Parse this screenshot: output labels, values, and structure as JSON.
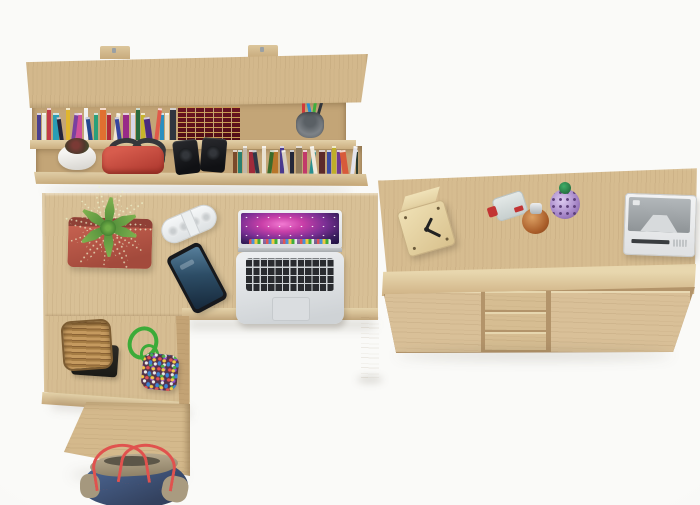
{
  "meta": {
    "width": 700,
    "height": 505,
    "scene": "Overhead product render of a light Sonoma-oak home office set: wall shelf with books, L-shaped desk with laptop, and a two-door three-drawer sideboard"
  },
  "palette": {
    "background": "#fafaf8",
    "wood": "#d2b689",
    "wood_light": "#e2d0a8",
    "wood_dark": "#c3a375",
    "shadow": "rgba(70,60,45,0.16)",
    "planter_red": "#b5574a",
    "plant_green": "#5e9c3f",
    "handbag_red": "#c94f43",
    "tote_denim": "#33415e",
    "tote_khaki": "#a99b80",
    "tote_strap_red": "#e0524e",
    "speaker_white": "#f0f2f3",
    "phone_black": "#17191d",
    "phone_screen_blue": "#2d4d66",
    "laptop_silver": "#dfe2e5",
    "keyboard_black": "#292b2f",
    "wallpaper_magenta": "#c93fa8",
    "classic_book_burgundy": "#6b1521",
    "classic_book_gold": "#d2aa50",
    "basket_tan": "#b98f57",
    "tray_black": "#26241f",
    "rope_green": "#3cab39",
    "clock_wood": "#e8d7ab",
    "clock_hands": "#222222",
    "radio_body": "#eef0f1",
    "radio_panel": "#9aa0a4",
    "bottle_red_cap": "#c23434",
    "bottle_amber": "#b96a30",
    "bottle_purple": "#a281c4",
    "bottle_green_cap": "#1d5c33",
    "bowl_white": "#f2f2f0"
  },
  "shelf": {
    "label": "wall shelf with two open rows and mounting brackets",
    "items": [
      "row of colorful paperback books",
      "set of burgundy leather classic volumes",
      "metal pen cup with pens",
      "white bowl with small succulent",
      "red handbag with dark handles",
      "pair of black speakers",
      "second row of books"
    ],
    "upper_books": [
      "#4a3f8f",
      "#e8e4da",
      "#c23a4a",
      "#2a9db5",
      "#23243a",
      "#e0b62e",
      "#7a3fa0",
      "#d14f9a",
      "#efefef",
      "#25488f",
      "#2aa07a",
      "#e07030",
      "#b02a3a",
      "#f0e6d4",
      "#36459f",
      "#982a88",
      "#d8d8e8",
      "#2a6b3f",
      "#c8b42a",
      "#4a2a7f",
      "#e05a4a",
      "#2a8fbf",
      "#ece0c6",
      "#30353f"
    ],
    "classic_volumes": [
      "#6b1521",
      "#701824",
      "#661320",
      "#6b1521",
      "#731a26",
      "#661320",
      "#6b1521"
    ],
    "pens": [
      "#d23a3a",
      "#2a8fd2",
      "#3fae3c",
      "#30343a"
    ],
    "lower_books": [
      "#7a4a2a",
      "#2a7f6f",
      "#c2b8a8",
      "#9f2a3a",
      "#2f3848",
      "#e8e0d0",
      "#3a6b2a",
      "#b8762a",
      "#4a3a8f",
      "#d8cfc0",
      "#23283a",
      "#8f7a5a",
      "#c23a6a",
      "#2a8f8f",
      "#efe8da",
      "#5c2a2a",
      "#3a4a9f",
      "#bfae2a",
      "#703a8f",
      "#d85a3a",
      "#e4e4ec",
      "#2a3a2f"
    ]
  },
  "desk": {
    "label": "L-shaped oak desk with right return and drawer pedestal",
    "items": [
      "red square planter with spiky succulent",
      "white portable pill speaker",
      "black smartphone",
      "silver open laptop with purple space wallpaper",
      "wicker basket on black tray",
      "green rope keyring with multicolor bead pouch"
    ]
  },
  "floor": {
    "items": [
      "denim tote bag with red straps"
    ]
  },
  "sideboard": {
    "label": "oak sideboard with two doors and three center drawers",
    "items": [
      "wooden cube desk clock",
      "clear perfume bottle with red cap",
      "amber round perfume bottle with silver cap",
      "purple round perfume bottle with green cap",
      "white retro radio"
    ],
    "doors": 2,
    "drawers": 3
  }
}
